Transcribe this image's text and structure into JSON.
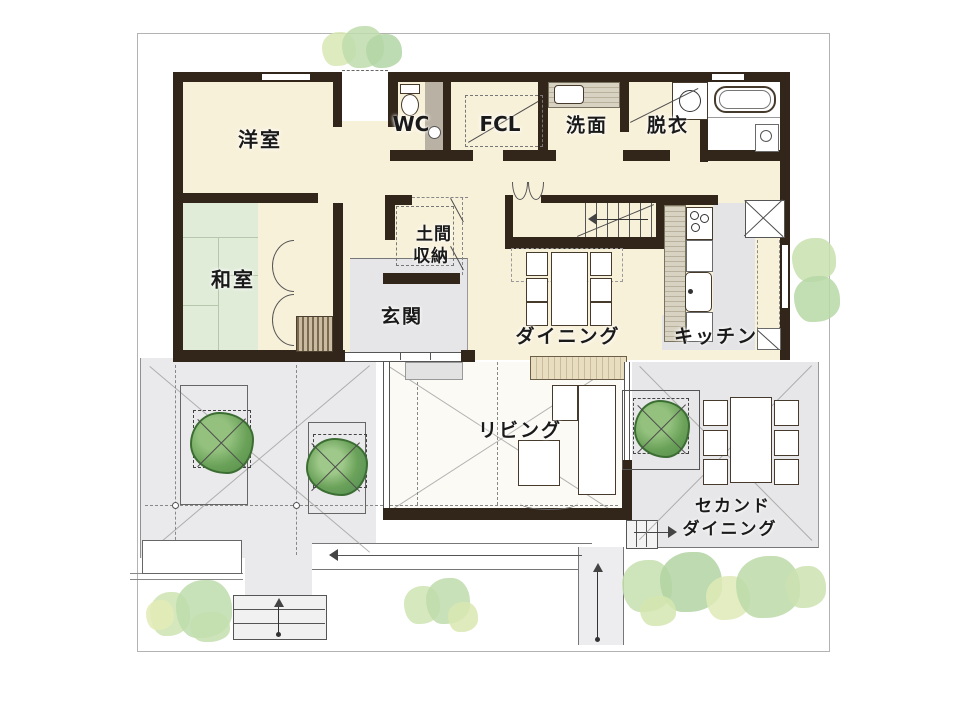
{
  "labels": {
    "western_room": "洋室",
    "japanese_room": "和室",
    "wc": "WC",
    "fcl": "FCL",
    "washroom": "洗面",
    "dressing_room": "脱衣",
    "doma_storage_line1": "土間",
    "doma_storage_line2": "収納",
    "entrance": "玄関",
    "dining": "ダイニング",
    "kitchen": "キッチン",
    "living": "リビング",
    "second_dining_line1": "セカンド",
    "second_dining_line2": "ダイニング"
  },
  "colors": {
    "wall": "#32261a",
    "floor_cream": "#f8f1da",
    "tatami_green": "#e0ecd8",
    "floor_gray": "#e6e5e7",
    "living_white": "#fbfaf5",
    "tree_green": "#6ba25a",
    "bush_green": "#c0dcab"
  }
}
